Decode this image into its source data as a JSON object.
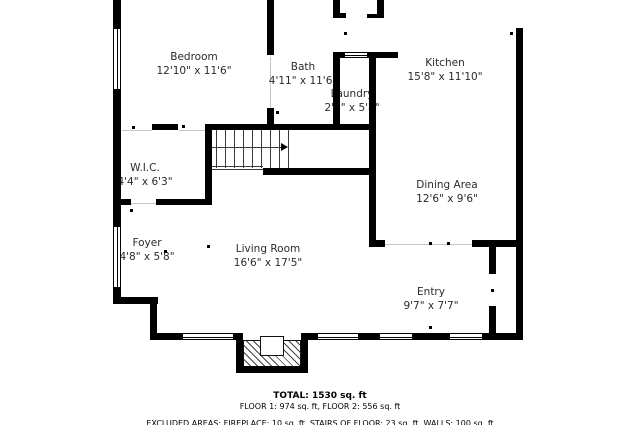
{
  "plan_title": "floor-plan",
  "rooms": [
    {
      "name": "Bedroom",
      "dims": "12'10\" x 11'6\"",
      "x": 194,
      "y": 50
    },
    {
      "name": "Bath",
      "dims": "4'11\" x 11'6\"",
      "x": 303,
      "y": 60
    },
    {
      "name": "Kitchen",
      "dims": "15'8\" x 11'10\"",
      "x": 445,
      "y": 56
    },
    {
      "name": "Laundry",
      "dims": "2'9\" x 5'8\"",
      "x": 352,
      "y": 87
    },
    {
      "name": "W.I.C.",
      "dims": "4'4\" x 6'3\"",
      "x": 145,
      "y": 161
    },
    {
      "name": "Dining Area",
      "dims": "12'6\" x 9'6\"",
      "x": 447,
      "y": 178
    },
    {
      "name": "Foyer",
      "dims": "4'8\" x 5'8\"",
      "x": 147,
      "y": 236
    },
    {
      "name": "Living Room",
      "dims": "16'6\" x 17'5\"",
      "x": 268,
      "y": 242
    },
    {
      "name": "Entry",
      "dims": "9'7\" x 7'7\"",
      "x": 431,
      "y": 285
    }
  ],
  "footer": {
    "total": "TOTAL: 1530 sq. ft",
    "floors": "FLOOR 1: 974 sq. ft, FLOOR 2: 556 sq. ft",
    "excluded": "EXCLUDED AREAS: FIREPLACE: 10 sq. ft, STAIRS OF FLOOR: 23 sq. ft, WALLS: 100 sq. ft"
  },
  "colors": {
    "wall": "#000000",
    "text": "#2b2b2b",
    "background": "#ffffff"
  },
  "geometry": {
    "walls": [
      [
        113,
        0,
        8,
        30
      ],
      [
        113,
        88,
        8,
        140
      ],
      [
        113,
        286,
        8,
        14
      ],
      [
        113,
        297,
        45,
        7
      ],
      [
        150,
        297,
        7,
        43
      ],
      [
        150,
        333,
        34,
        7
      ],
      [
        232,
        333,
        8,
        7
      ],
      [
        303,
        333,
        16,
        7
      ],
      [
        357,
        333,
        24,
        7
      ],
      [
        411,
        333,
        40,
        7
      ],
      [
        481,
        333,
        42,
        7
      ],
      [
        516,
        28,
        7,
        312
      ],
      [
        267,
        0,
        7,
        55
      ],
      [
        267,
        108,
        7,
        22
      ],
      [
        333,
        0,
        7,
        18
      ],
      [
        333,
        13,
        13,
        5
      ],
      [
        377,
        0,
        7,
        18
      ],
      [
        367,
        14,
        12,
        4
      ],
      [
        333,
        52,
        65,
        6
      ],
      [
        333,
        52,
        7,
        76
      ],
      [
        369,
        52,
        7,
        195
      ],
      [
        152,
        124,
        26,
        6
      ],
      [
        205,
        124,
        170,
        6
      ],
      [
        205,
        124,
        7,
        81
      ],
      [
        113,
        199,
        18,
        6
      ],
      [
        156,
        199,
        56,
        6
      ],
      [
        263,
        168,
        113,
        7
      ],
      [
        369,
        240,
        16,
        7
      ],
      [
        472,
        240,
        51,
        7
      ],
      [
        489,
        247,
        7,
        27
      ],
      [
        489,
        306,
        7,
        30
      ],
      [
        236,
        333,
        7,
        40
      ],
      [
        301,
        333,
        7,
        40
      ],
      [
        236,
        366,
        72,
        7
      ]
    ],
    "windows": [
      [
        113,
        28,
        8,
        62
      ],
      [
        113,
        226,
        8,
        62
      ],
      [
        182,
        333,
        52,
        7
      ],
      [
        317,
        333,
        42,
        7
      ],
      [
        379,
        333,
        34,
        7
      ],
      [
        449,
        333,
        34,
        7
      ],
      [
        344,
        52,
        24,
        6
      ]
    ],
    "thresholds": [
      [
        122,
        130,
        30,
        1
      ],
      [
        179,
        130,
        26,
        1
      ],
      [
        131,
        203,
        25,
        1
      ],
      [
        270,
        57,
        1,
        51
      ],
      [
        384,
        244,
        88,
        1
      ]
    ],
    "dots": [
      [
        132,
        126
      ],
      [
        182,
        125
      ],
      [
        269,
        111
      ],
      [
        276,
        111
      ],
      [
        344,
        32
      ],
      [
        510,
        32
      ],
      [
        372,
        170
      ],
      [
        429,
        242
      ],
      [
        447,
        242
      ],
      [
        491,
        289
      ],
      [
        429,
        326
      ],
      [
        164,
        250
      ],
      [
        207,
        245
      ],
      [
        130,
        209
      ]
    ],
    "stairs": {
      "treads_x": [
        207,
        216,
        225,
        234,
        243,
        252,
        261,
        270,
        279,
        288
      ],
      "tread_y": 128,
      "tread_h": 40,
      "runner": [
        208,
        147,
        74,
        1
      ],
      "edge_lines": [
        [
          207,
          166,
          56,
          1
        ],
        [
          207,
          169,
          56,
          1
        ]
      ],
      "arrow": [
        281,
        143
      ]
    },
    "fireplace": {
      "hatch": [
        243,
        340,
        58,
        27
      ],
      "notch": [
        260,
        336,
        24,
        20
      ]
    }
  }
}
